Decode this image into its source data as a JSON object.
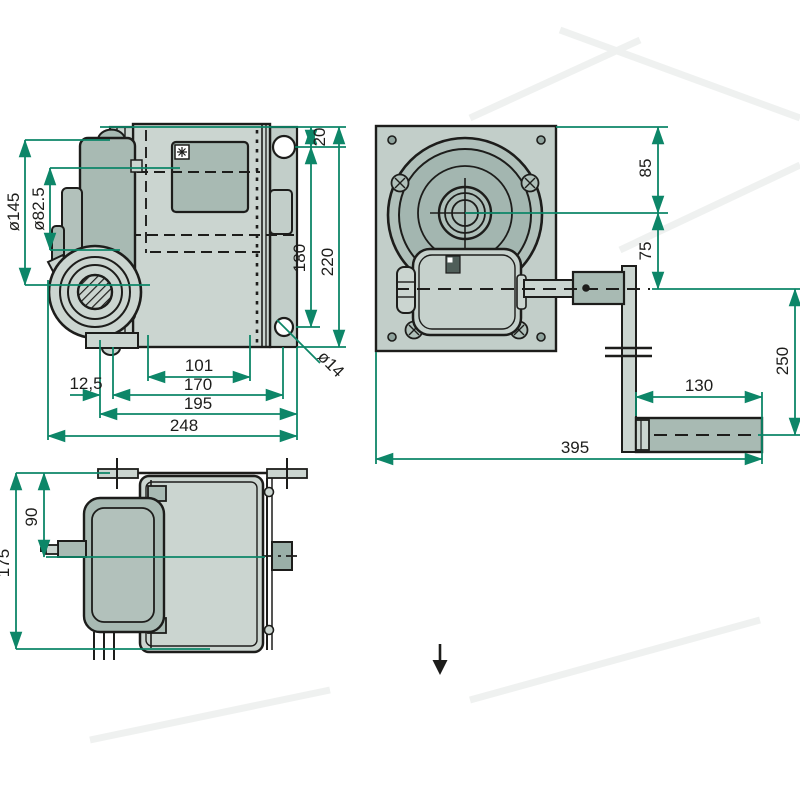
{
  "drawing": {
    "type": "technical-drawing",
    "subject": "hand winch, three orthographic views with dimensions (mm)",
    "colors": {
      "dimension_line": "#0d8668",
      "outline": "#1d1d1b",
      "fill_light": "#cbd5d0",
      "fill_plate": "#c2cec9",
      "fill_mid": "#a8bab3",
      "fill_drum_face": "#a3b6b0",
      "background": "#ffffff"
    },
    "views": {
      "side_view": {
        "dims": {
          "flange_diameter": "ø145",
          "motor_diameter": "ø82.5",
          "hole_offset_top": "20",
          "plate_height": "220",
          "hole_spacing": "180",
          "drum_inner_width": "101",
          "mount_offset": "12,5",
          "width_170": "170",
          "width_195": "195",
          "overall_width": "248",
          "hole_diameter": "ø14"
        }
      },
      "front_view": {
        "dims": {
          "top_to_axis": "85",
          "axis_to_crank": "75",
          "crank_radius": "250",
          "handle_length": "130",
          "overall_length": "395"
        }
      },
      "bottom_view": {
        "dims": {
          "depth_90": "90",
          "overall_depth": "175"
        }
      }
    }
  }
}
